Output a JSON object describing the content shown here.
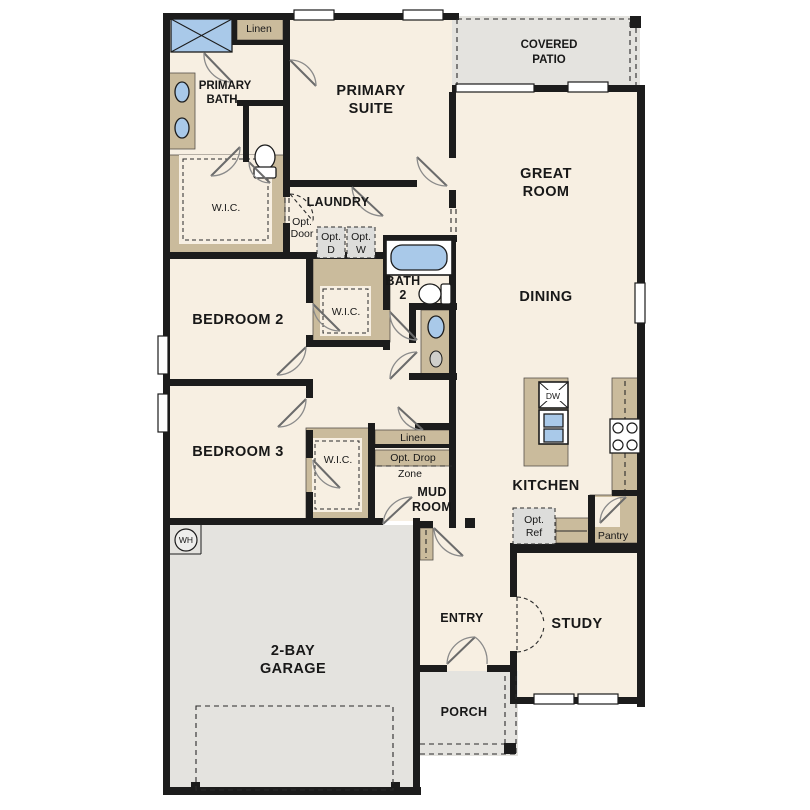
{
  "colors": {
    "wall": "#1c1c1c",
    "floor": "#f7efe2",
    "cabinet_tan": "#cabb9c",
    "outdoor_gray": "#e4e3df",
    "fixture_blue": "#a9c9e9",
    "option_gray": "#dddddb"
  },
  "rooms": {
    "primary_bath": {
      "line1": "PRIMARY",
      "line2": "BATH"
    },
    "primary_suite": {
      "line1": "PRIMARY",
      "line2": "SUITE"
    },
    "covered_patio": {
      "line1": "COVERED",
      "line2": "PATIO"
    },
    "great_room": {
      "line1": "GREAT",
      "line2": "ROOM"
    },
    "dining": {
      "label": "DINING"
    },
    "laundry": {
      "label": "LAUNDRY"
    },
    "bath_2": {
      "line1": "BATH",
      "line2": "2"
    },
    "bedroom_2": {
      "label": "BEDROOM 2"
    },
    "bedroom_3": {
      "label": "BEDROOM 3"
    },
    "kitchen": {
      "label": "KITCHEN"
    },
    "mud_room": {
      "line1": "MUD",
      "line2": "ROOM"
    },
    "study": {
      "label": "STUDY"
    },
    "entry": {
      "label": "ENTRY"
    },
    "porch": {
      "label": "PORCH"
    },
    "garage": {
      "line1": "2-BAY",
      "line2": "GARAGE"
    }
  },
  "closets": {
    "linen_bath": {
      "label": "Linen"
    },
    "wic_primary": {
      "label": "W.I.C."
    },
    "wic_bedroom2": {
      "label": "W.I.C."
    },
    "wic_bedroom3": {
      "label": "W.I.C."
    },
    "linen_mud": {
      "label": "Linen"
    },
    "pantry": {
      "label": "Pantry"
    }
  },
  "options": {
    "opt_door": {
      "line1": "Opt.",
      "line2": "Door"
    },
    "opt_dryer": {
      "line1": "Opt.",
      "line2": "D"
    },
    "opt_washer": {
      "line1": "Opt.",
      "line2": "W"
    },
    "opt_drop_zone": {
      "line1": "Opt. Drop",
      "line2": "Zone"
    },
    "opt_ref": {
      "line1": "Opt.",
      "line2": "Ref"
    }
  },
  "appliances": {
    "dishwasher": {
      "label": "DW"
    },
    "water_heater": {
      "label": "WH"
    }
  }
}
